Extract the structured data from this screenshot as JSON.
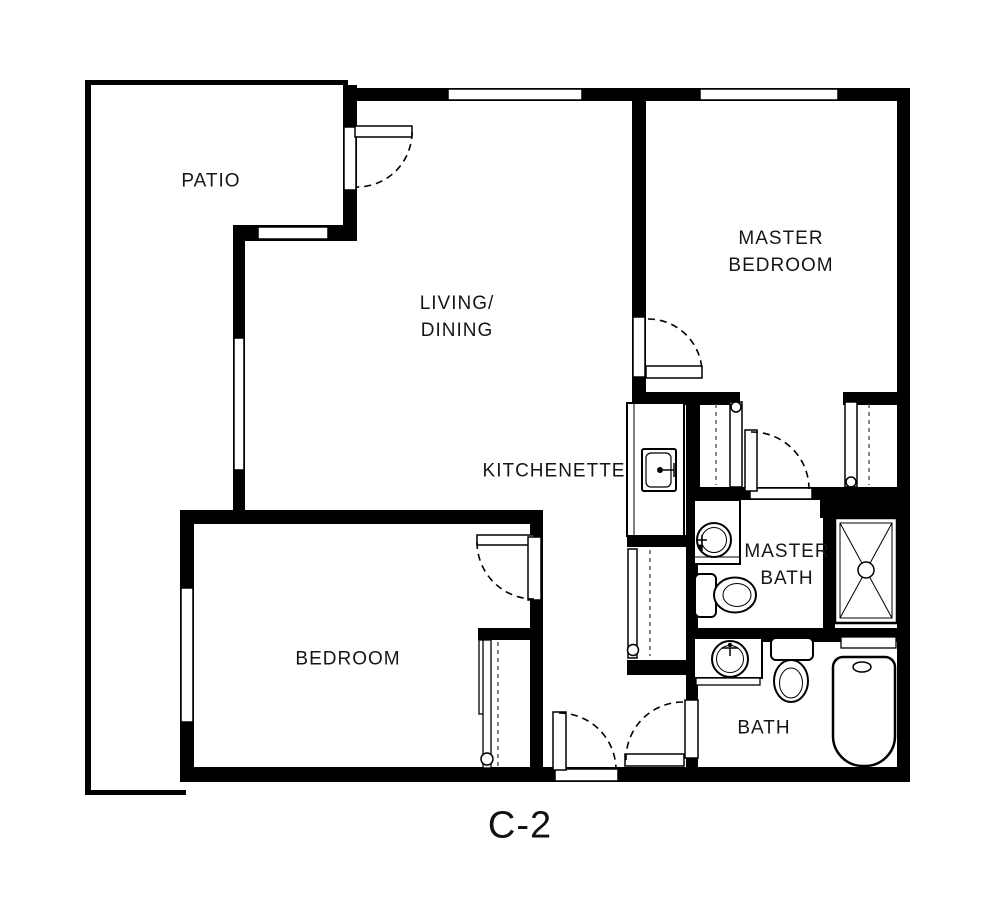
{
  "plan_code": "C-2",
  "colors": {
    "background": "#ffffff",
    "wall": "#000000",
    "line": "#000000",
    "text": "#161616"
  },
  "rooms": {
    "patio": {
      "label": "PATIO"
    },
    "living_dining": {
      "line1": "LIVING/",
      "line2": "DINING"
    },
    "master_bedroom": {
      "line1": "MASTER",
      "line2": "BEDROOM"
    },
    "kitchenette": {
      "label": "KITCHENETTE"
    },
    "master_bath": {
      "line1": "MASTER",
      "line2": "BATH"
    },
    "bedroom": {
      "label": "BEDROOM"
    },
    "bath": {
      "label": "BATH"
    }
  },
  "fixtures": {
    "kitchenette_sink": "square-sink-icon",
    "master_bath_sink": "round-sink-icon",
    "master_bath_toilet": "toilet-icon",
    "shower": "shower-x-icon",
    "bath_sink": "round-sink-icon",
    "bath_toilet": "toilet-icon",
    "bathtub": "bathtub-icon",
    "hall_closet": "closet-dashed-rod",
    "bedroom_closet": "closet-dashed-rod",
    "master_closet_left": "closet-dashed-rod",
    "master_closet_right": "closet-dashed-rod"
  },
  "doors": [
    "patio-door",
    "master-bedroom-door",
    "bedroom-door",
    "entry-door",
    "bath-door",
    "master-bath-door"
  ],
  "windows": [
    "window-top-living",
    "window-top-master-bedroom",
    "window-patio-wall",
    "window-living-west",
    "window-bedroom-west"
  ]
}
